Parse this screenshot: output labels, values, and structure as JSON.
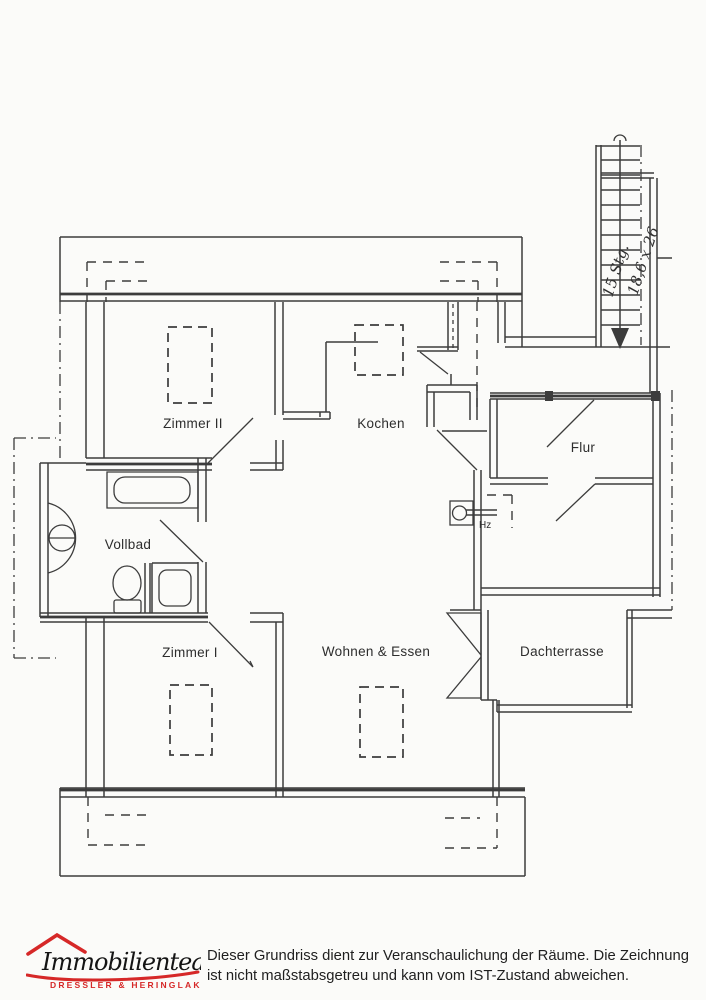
{
  "plan": {
    "rooms": [
      {
        "label": "Zimmer II"
      },
      {
        "label": "Kochen"
      },
      {
        "label": "Flur"
      },
      {
        "label": "Vollbad"
      },
      {
        "label": "Zimmer I"
      },
      {
        "label": "Wohnen & Essen"
      },
      {
        "label": "Dachterrasse"
      }
    ],
    "stair": {
      "steps": "15 Stg.",
      "tread": "18,6 x 26"
    },
    "heating_label": "Hz",
    "line_color": "#3c3c3c"
  },
  "footer": {
    "logo": {
      "name": "Immobilienteam",
      "subtitle": "DRESSLER & HERINGLAKE",
      "accent": "#d62828"
    },
    "disclaimer": {
      "line1": "Dieser Grundriss dient zur Veranschaulichung der Räume. Die Zeichnung",
      "line2": "ist nicht maßstabsgetreu und kann vom IST-Zustand abweichen."
    }
  }
}
